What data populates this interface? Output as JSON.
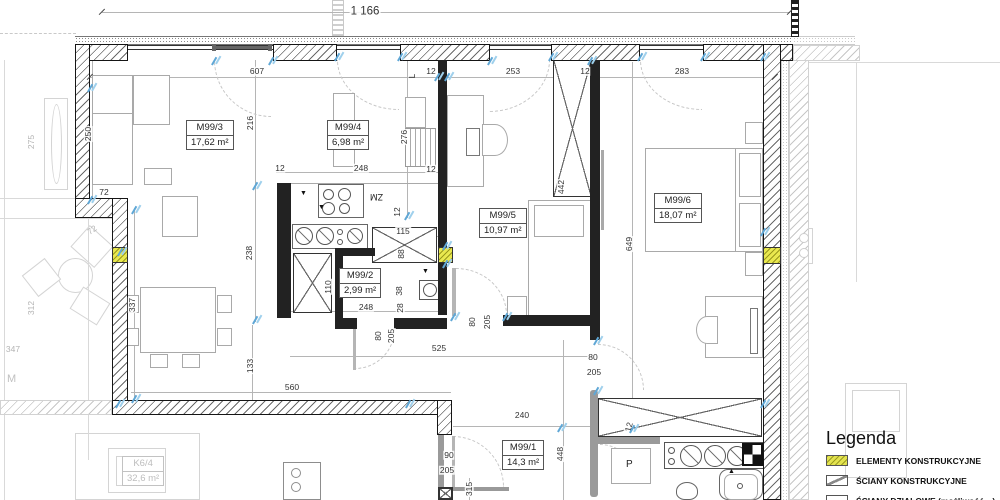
{
  "legend": {
    "title": "Legenda",
    "items": [
      {
        "label": "ELEMENTY KONSTRUKCYJNE",
        "swatch": "yellow-hatch",
        "color": "#e3e34f"
      },
      {
        "label": "ŚCIANY KONSTRUKCYJNE",
        "swatch": "diagonal-hatch",
        "color": "#ffffff"
      },
      {
        "label": "ŚCIANY DZIAŁOWE (możliwość…)",
        "swatch": "thin-outline",
        "color": "#ffffff"
      }
    ]
  },
  "rooms": [
    {
      "id": "M99/3",
      "area": "17,62 m²"
    },
    {
      "id": "M99/4",
      "area": "6,98 m²"
    },
    {
      "id": "M99/2",
      "area": "2,99 m²"
    },
    {
      "id": "M99/5",
      "area": "10,97 m²"
    },
    {
      "id": "M99/6",
      "area": "18,07 m²"
    },
    {
      "id": "M99/1",
      "area": "14,3 m²"
    },
    {
      "id": "K6/4",
      "area": "32,6 m²",
      "muted": true
    }
  ],
  "annotations": {
    "dishwasher": "ZM",
    "fridge": "L",
    "washing_machine": "P",
    "neighbor_text": "M"
  },
  "dimensions": [
    {
      "t": "1 166",
      "x": 365,
      "y": 12,
      "big": 1
    },
    {
      "t": "607",
      "x": 257,
      "y": 71
    },
    {
      "t": "12",
      "x": 431,
      "y": 71
    },
    {
      "t": "253",
      "x": 513,
      "y": 71
    },
    {
      "t": "12",
      "x": 585,
      "y": 71
    },
    {
      "t": "283",
      "x": 682,
      "y": 71
    },
    {
      "t": "250",
      "x": 88,
      "y": 134,
      "r": -90
    },
    {
      "t": "216",
      "x": 250,
      "y": 123,
      "r": -90
    },
    {
      "t": "276",
      "x": 404,
      "y": 137,
      "r": -90
    },
    {
      "t": "72",
      "x": 104,
      "y": 192
    },
    {
      "t": "72",
      "x": 92,
      "y": 230,
      "r": -35,
      "m": 1
    },
    {
      "t": "275",
      "x": 31,
      "y": 142,
      "r": -90,
      "m": 1
    },
    {
      "t": "312",
      "x": 31,
      "y": 308,
      "r": -90,
      "m": 1
    },
    {
      "t": "347",
      "x": 13,
      "y": 349,
      "m": 1
    },
    {
      "t": "337",
      "x": 132,
      "y": 305,
      "r": -90
    },
    {
      "t": "238",
      "x": 249,
      "y": 253,
      "r": -90
    },
    {
      "t": "12",
      "x": 280,
      "y": 168
    },
    {
      "t": "248",
      "x": 361,
      "y": 168
    },
    {
      "t": "12",
      "x": 431,
      "y": 169
    },
    {
      "t": "12",
      "x": 397,
      "y": 212,
      "r": -90
    },
    {
      "t": "115",
      "x": 403,
      "y": 231
    },
    {
      "t": "88",
      "x": 401,
      "y": 254,
      "r": -90
    },
    {
      "t": "110",
      "x": 328,
      "y": 287,
      "r": -90
    },
    {
      "t": "38",
      "x": 399,
      "y": 291,
      "r": -90
    },
    {
      "t": "28",
      "x": 400,
      "y": 308,
      "r": -90
    },
    {
      "t": "248",
      "x": 366,
      "y": 307
    },
    {
      "t": "80",
      "x": 378,
      "y": 336,
      "r": -90
    },
    {
      "t": "205",
      "x": 391,
      "y": 336,
      "r": -90
    },
    {
      "t": "80",
      "x": 472,
      "y": 322,
      "r": -90
    },
    {
      "t": "205",
      "x": 487,
      "y": 322,
      "r": -90
    },
    {
      "t": "525",
      "x": 439,
      "y": 348
    },
    {
      "t": "80",
      "x": 593,
      "y": 357
    },
    {
      "t": "205",
      "x": 594,
      "y": 372
    },
    {
      "t": "649",
      "x": 629,
      "y": 244,
      "r": -90
    },
    {
      "t": "442",
      "x": 561,
      "y": 187,
      "r": -90
    },
    {
      "t": "133",
      "x": 250,
      "y": 366,
      "r": -90
    },
    {
      "t": "560",
      "x": 292,
      "y": 387
    },
    {
      "t": "240",
      "x": 522,
      "y": 415
    },
    {
      "t": "448",
      "x": 560,
      "y": 454,
      "r": -90
    },
    {
      "t": "90",
      "x": 449,
      "y": 455
    },
    {
      "t": "205",
      "x": 447,
      "y": 470
    },
    {
      "t": "315",
      "x": 469,
      "y": 489,
      "r": -90
    },
    {
      "t": "12",
      "x": 629,
      "y": 427,
      "r": -75
    }
  ],
  "ticks_cyan": [
    [
      90,
      88
    ],
    [
      90,
      200
    ],
    [
      120,
      252
    ],
    [
      134,
      210
    ],
    [
      134,
      399
    ],
    [
      214,
      61
    ],
    [
      271,
      61
    ],
    [
      255,
      186
    ],
    [
      255,
      320
    ],
    [
      337,
      57
    ],
    [
      400,
      57
    ],
    [
      407,
      216
    ],
    [
      437,
      77
    ],
    [
      447,
      77
    ],
    [
      490,
      61
    ],
    [
      551,
      57
    ],
    [
      590,
      61
    ],
    [
      640,
      57
    ],
    [
      703,
      57
    ],
    [
      763,
      232
    ],
    [
      763,
      57
    ],
    [
      445,
      246
    ],
    [
      445,
      264
    ],
    [
      453,
      317
    ],
    [
      505,
      317
    ],
    [
      596,
      341
    ],
    [
      596,
      391
    ],
    [
      560,
      428
    ],
    [
      632,
      429
    ],
    [
      118,
      404
    ],
    [
      408,
      404
    ],
    [
      763,
      404
    ]
  ],
  "ticks_dark": [
    [
      102,
      12
    ],
    [
      790,
      12
    ],
    [
      90,
      77
    ],
    [
      775,
      77
    ]
  ]
}
